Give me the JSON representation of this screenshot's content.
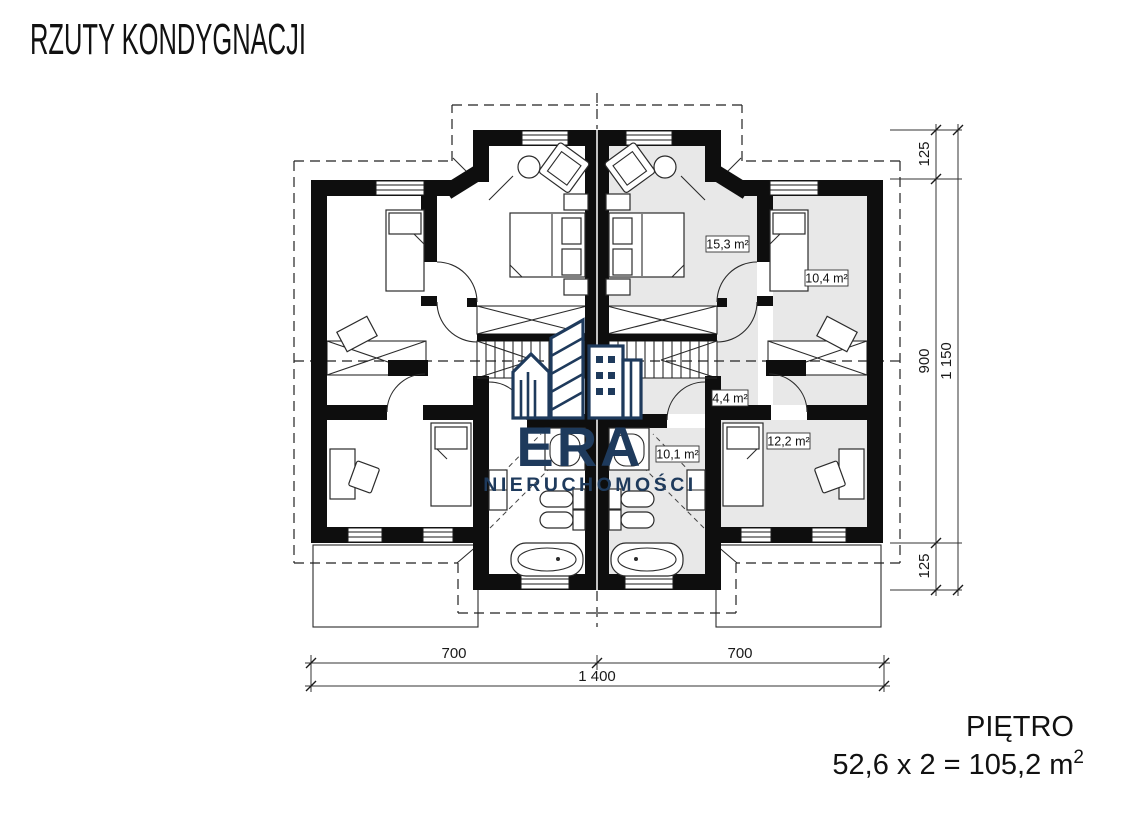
{
  "header": {
    "title": "RZUTY KONDYGNACJI"
  },
  "logo": {
    "era": "ERA",
    "subtitle": "NIERUCHOMOŚCI",
    "color": "#1e3a5c"
  },
  "plan": {
    "room_labels": [
      {
        "room": "master-bedroom-right",
        "text": "15,3 m²"
      },
      {
        "room": "bedroom-top-right",
        "text": "10,4 m²"
      },
      {
        "room": "hall-right",
        "text": "4,4 m²"
      },
      {
        "room": "bathroom-right",
        "text": "10,1 m²"
      },
      {
        "room": "bedroom-bottom-right",
        "text": "12,2 m²"
      }
    ],
    "colors": {
      "room_fill": "#e8e8e8",
      "wall": "#0e0e0e"
    }
  },
  "dimensions": {
    "bottom": {
      "segments": [
        "700",
        "700"
      ],
      "total": "1 400"
    },
    "right": {
      "segments": [
        "125",
        "900",
        "125"
      ],
      "total": "1 150"
    }
  },
  "footer": {
    "floor": "PIĘTRO",
    "area": "52,6 x 2 = 105,2 m",
    "area_sup": "2"
  }
}
